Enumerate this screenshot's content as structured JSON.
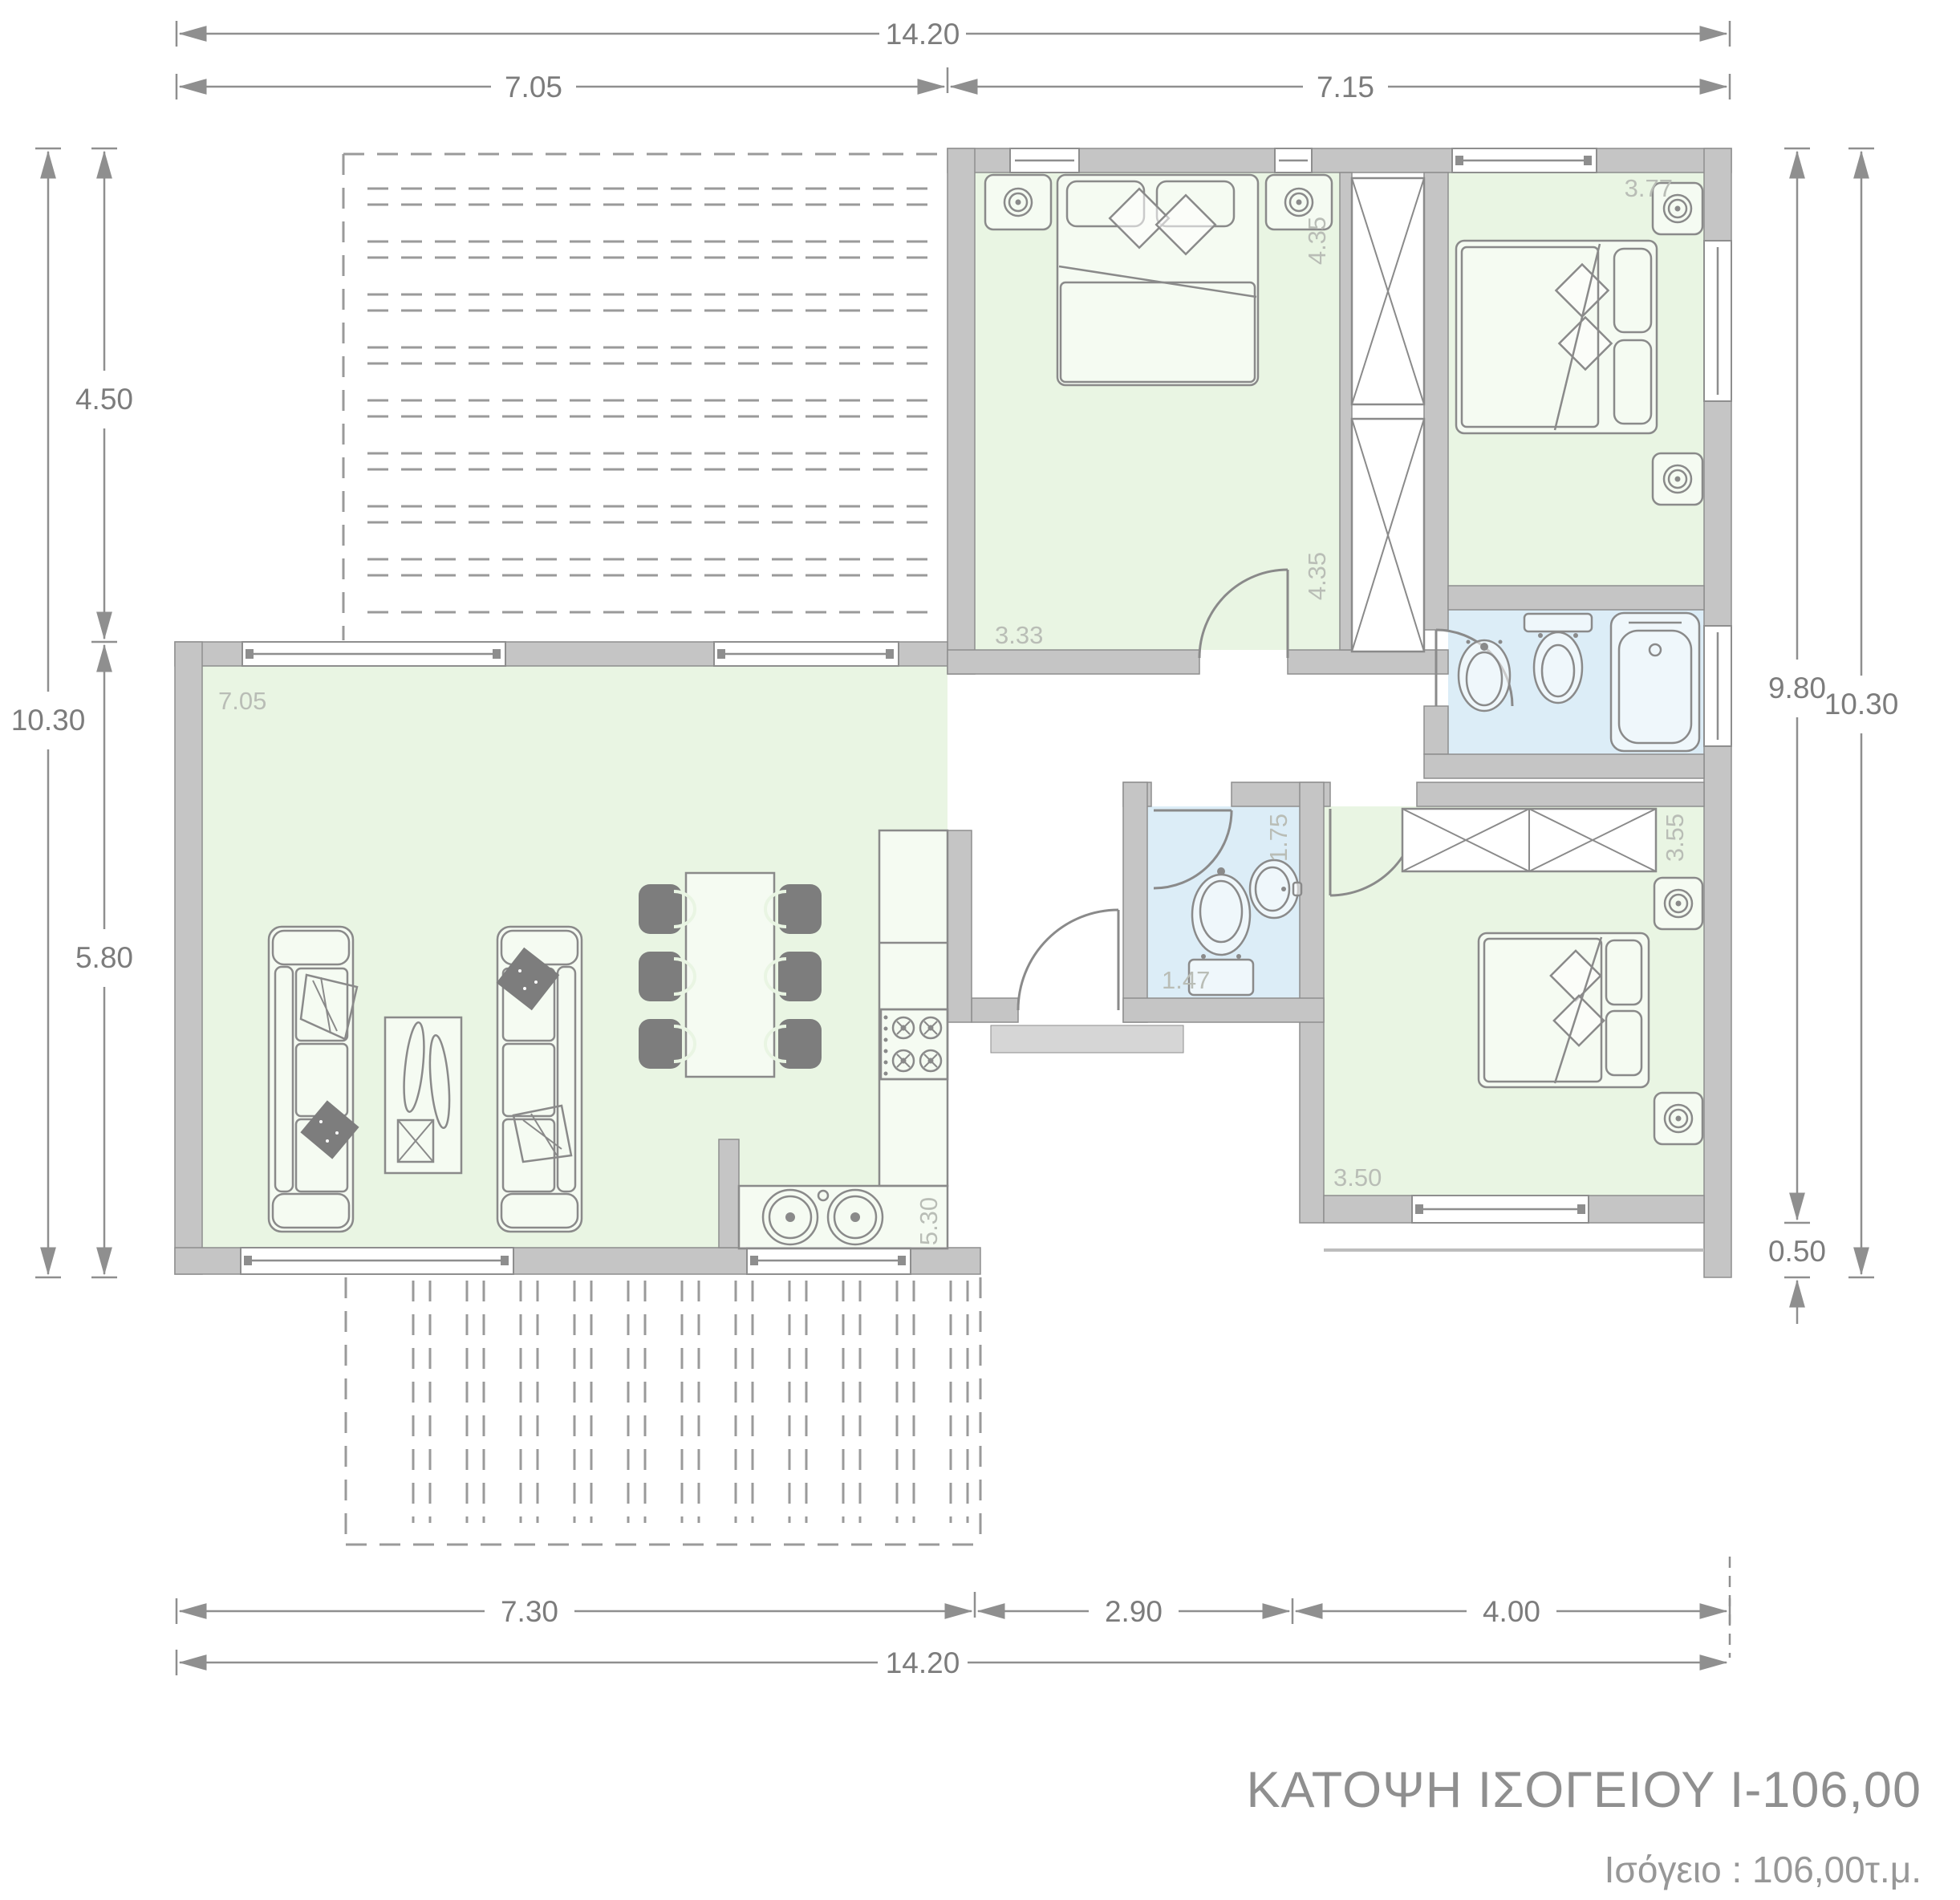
{
  "title": {
    "main": "ΚΑΤΟΨΗ ΙΣΟΓΕΙΟΥ Ι-106,00",
    "subtitle": "Ισόγειο : 106,00τ.μ."
  },
  "dimensions": {
    "top_overall": "14.20",
    "top_left_wing": "7.05",
    "top_right_wing": "7.15",
    "left_overall": "10.30",
    "left_upper": "4.50",
    "left_lower": "5.80",
    "right_main": "9.80",
    "right_step": "0.50",
    "right_overall": "10.30",
    "bottom_living": "7.30",
    "bottom_entrance": "2.90",
    "bottom_bedroom": "4.00",
    "bottom_overall": "14.20"
  },
  "room_labels": {
    "living_width": "7.05",
    "kitchen_depth": "5.30",
    "bedroom1_width": "3.33",
    "bedroom1_depth": "4.35",
    "bedroom1_depth_lower": "4.35",
    "bedroom2_depth": "3.77",
    "wc_width": "1.47",
    "wc_depth": "1.75",
    "bedroom3_width": "3.50",
    "bedroom3_depth": "3.55"
  },
  "colors": {
    "wall_fill": "#c5c5c5",
    "wall_stroke": "#8e8e8e",
    "room_green": "#e9f5e3",
    "room_blue": "#dcedf7",
    "furniture_stroke": "#8a8a8a",
    "furniture_dark": "#7d7d7d",
    "dim_line": "#8f8f8f",
    "dim_text": "#7c7c7c",
    "room_label_text": "#b9bdb6",
    "title_text": "#8f8f8f",
    "deck_line": "#9a9a9a",
    "porch_fill": "#d6d6d6"
  }
}
